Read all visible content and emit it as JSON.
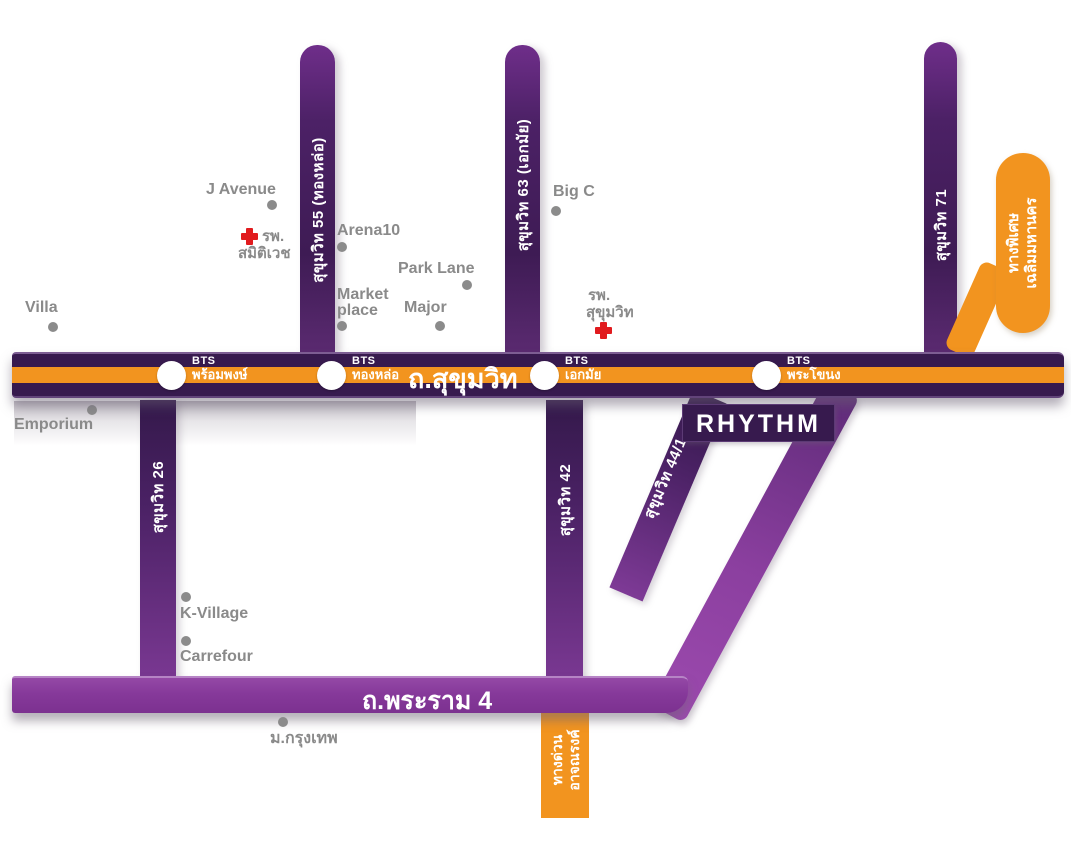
{
  "map": {
    "title": "RHYTHM Sukhumvit location map",
    "roads": {
      "sukhumvit": {
        "label": "ถ.สุขุมวิท"
      },
      "rama4": {
        "label": "ถ.พระราม 4"
      },
      "soi55": {
        "label": "สุขุมวิท 55 (ทองหล่อ)"
      },
      "soi63": {
        "label": "สุขุมวิท 63 (เอกมัย)"
      },
      "soi71": {
        "label": "สุขุมวิท 71"
      },
      "soi26": {
        "label": "สุขุมวิท 26"
      },
      "soi42": {
        "label": "สุขุมวิท 42"
      },
      "soi44_1": {
        "label": "สุขุมวิท 44/1"
      }
    },
    "expressways": {
      "chalerm_mahanakorn": {
        "line1": "ทางพิเศษ",
        "line2": "เฉลิมมหานคร"
      },
      "at_narong": {
        "line1": "ทางด่วน",
        "line2": "อาจณรงค์"
      }
    },
    "bts": {
      "prefix": "BTS",
      "stations": [
        {
          "name": "พร้อมพงษ์"
        },
        {
          "name": "ทองหล่อ"
        },
        {
          "name": "เอกมัย"
        },
        {
          "name": "พระโขนง"
        }
      ]
    },
    "project": {
      "name": "RHYTHM"
    },
    "landmarks": [
      {
        "name": "Villa"
      },
      {
        "name": "Emporium"
      },
      {
        "name": "J Avenue"
      },
      {
        "name": "Arena10"
      },
      {
        "name": "Park Lane"
      },
      {
        "name": "Market place",
        "lines": [
          "Market",
          "place"
        ]
      },
      {
        "name": "Major"
      },
      {
        "name": "Big C"
      },
      {
        "name": "K-Village"
      },
      {
        "name": "Carrefour"
      },
      {
        "name": "ม.กรุงเทพ"
      }
    ],
    "hospitals": [
      {
        "line1": "รพ.",
        "line2": "สมิติเวช"
      },
      {
        "line1": "รพ.",
        "line2": "สุขุมวิท"
      }
    ],
    "colors": {
      "road_deep_purple": "#371a4e",
      "soi_purple_dark": "#3e1b54",
      "soi_purple_light": "#7e3a96",
      "road_mid_purple": "#8b3f9f",
      "bts_line_orange": "#f2941f",
      "expressway_orange": "#f2941f",
      "landmark_gray": "#8a8a8a",
      "hospital_red": "#e11b1e",
      "bts_station_white": "#ffffff"
    }
  }
}
